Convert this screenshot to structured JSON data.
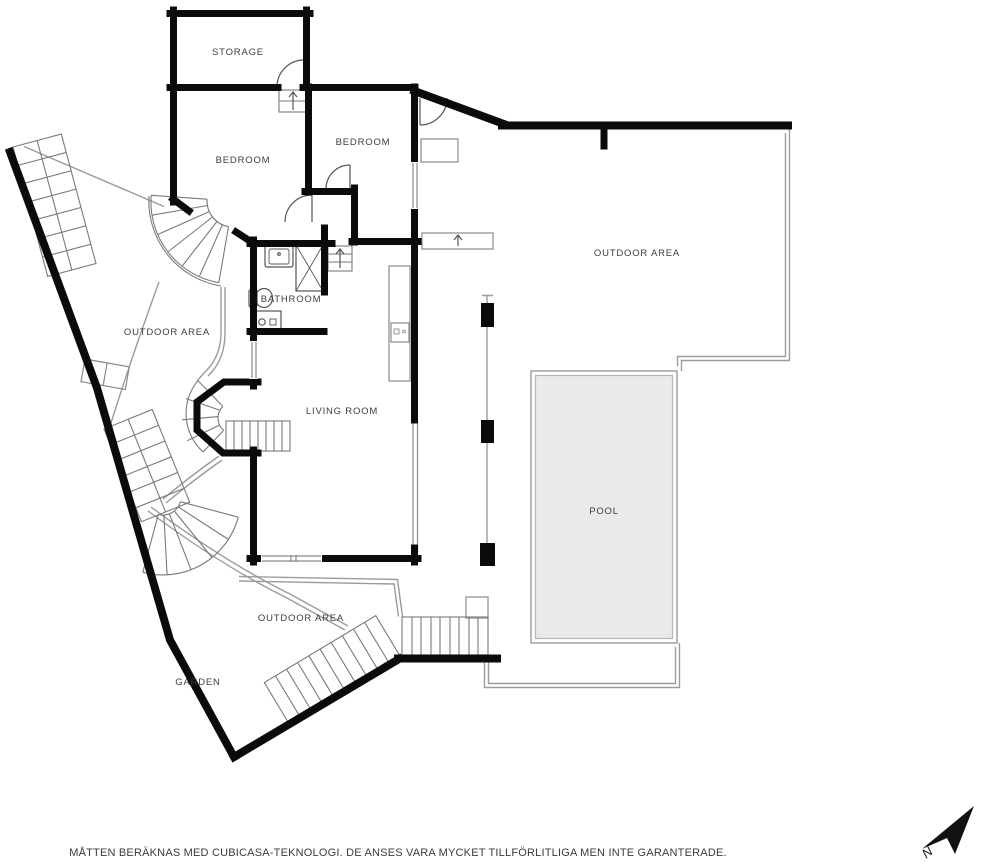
{
  "plan": {
    "rooms": [
      {
        "id": "storage",
        "label": "STORAGE"
      },
      {
        "id": "bedroom-1",
        "label": "BEDROOM"
      },
      {
        "id": "bedroom-2",
        "label": "BEDROOM"
      },
      {
        "id": "bathroom",
        "label": "BATHROOM"
      },
      {
        "id": "living-room",
        "label": "LIVING ROOM"
      },
      {
        "id": "pool",
        "label": "POOL"
      },
      {
        "id": "garden",
        "label": "GARDEN"
      },
      {
        "id": "outdoor-west",
        "label": "OUTDOOR AREA"
      },
      {
        "id": "outdoor-east",
        "label": "OUTDOOR AREA"
      },
      {
        "id": "outdoor-south",
        "label": "OUTDOOR AREA"
      }
    ],
    "compass": {
      "label": "N"
    },
    "footer": {
      "disclaimer": "MÅTTEN BERÄKNAS MED CUBICASA-TEKNOLOGI. DE ANSES VARA MYCKET TILLFÖRLITLIGA MEN INTE GARANTERADE."
    },
    "colors": {
      "wall": "#0b0b0b",
      "boundary": "#9b9b9b",
      "stair": "#7a7a7a",
      "fixture": "#555555",
      "pool_fill": "#e9eaea",
      "text": "#3d3d3d"
    }
  }
}
